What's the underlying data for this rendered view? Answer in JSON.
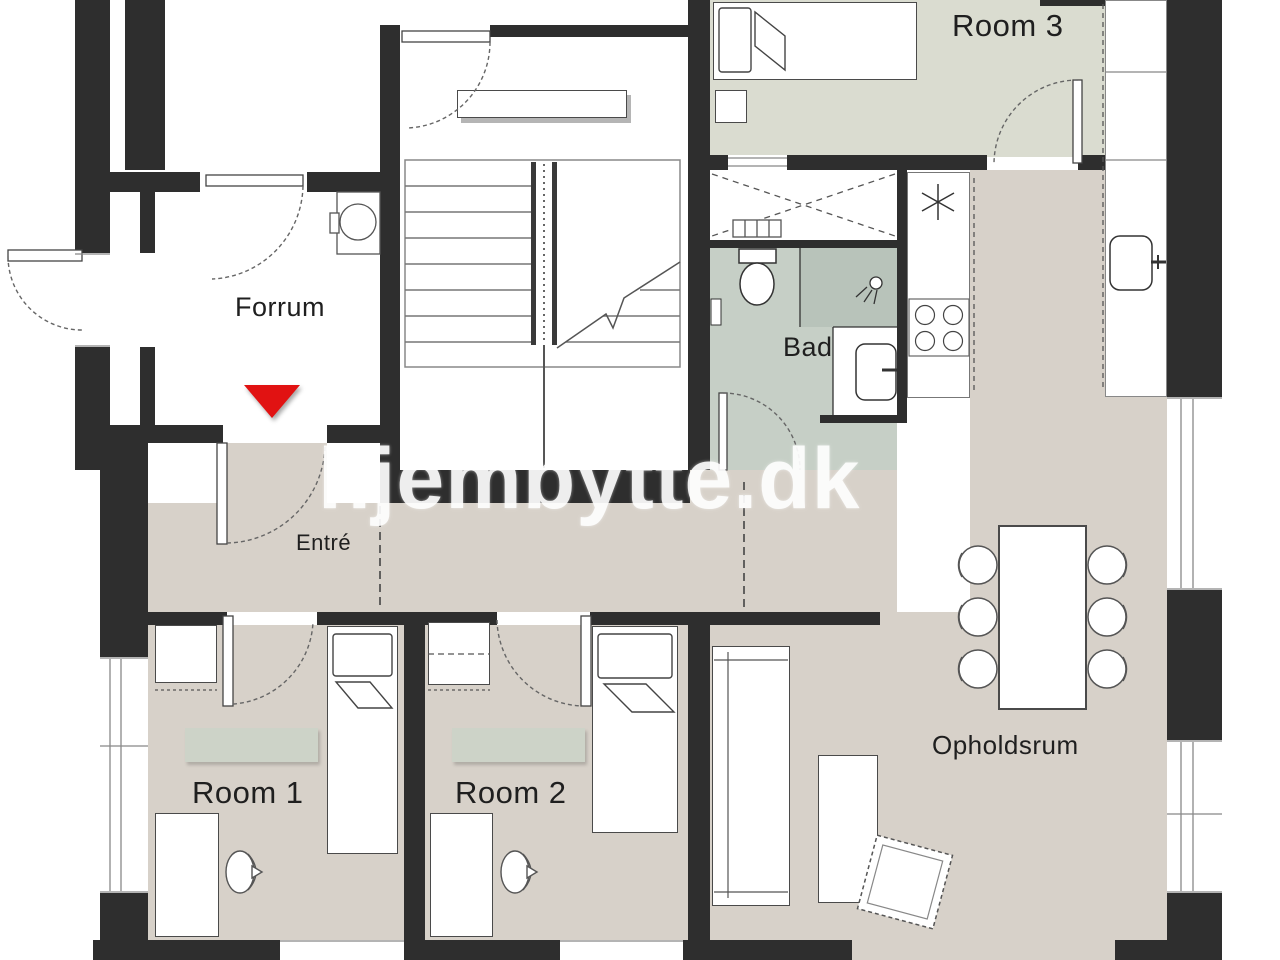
{
  "watermark": "hjembytte.dk",
  "labels": {
    "room1": "Room 1",
    "room2": "Room 2",
    "room3": "Room 3",
    "forrum": "Forrum",
    "bad": "Bad",
    "entre": "Entré",
    "opholdsrum": "Opholdsrum"
  },
  "colors": {
    "wall": "#2e2e2e",
    "floor-beige": "#d7d1c9",
    "floor-sage": "#dadcd0",
    "floor-bath": "#c6cfc6",
    "floor-shower": "#b8c3ba",
    "rug": "#cdd3c8",
    "entrance-marker": "#e11212",
    "watermark-color": "#ffffff",
    "label-color": "#1f1f1f"
  }
}
